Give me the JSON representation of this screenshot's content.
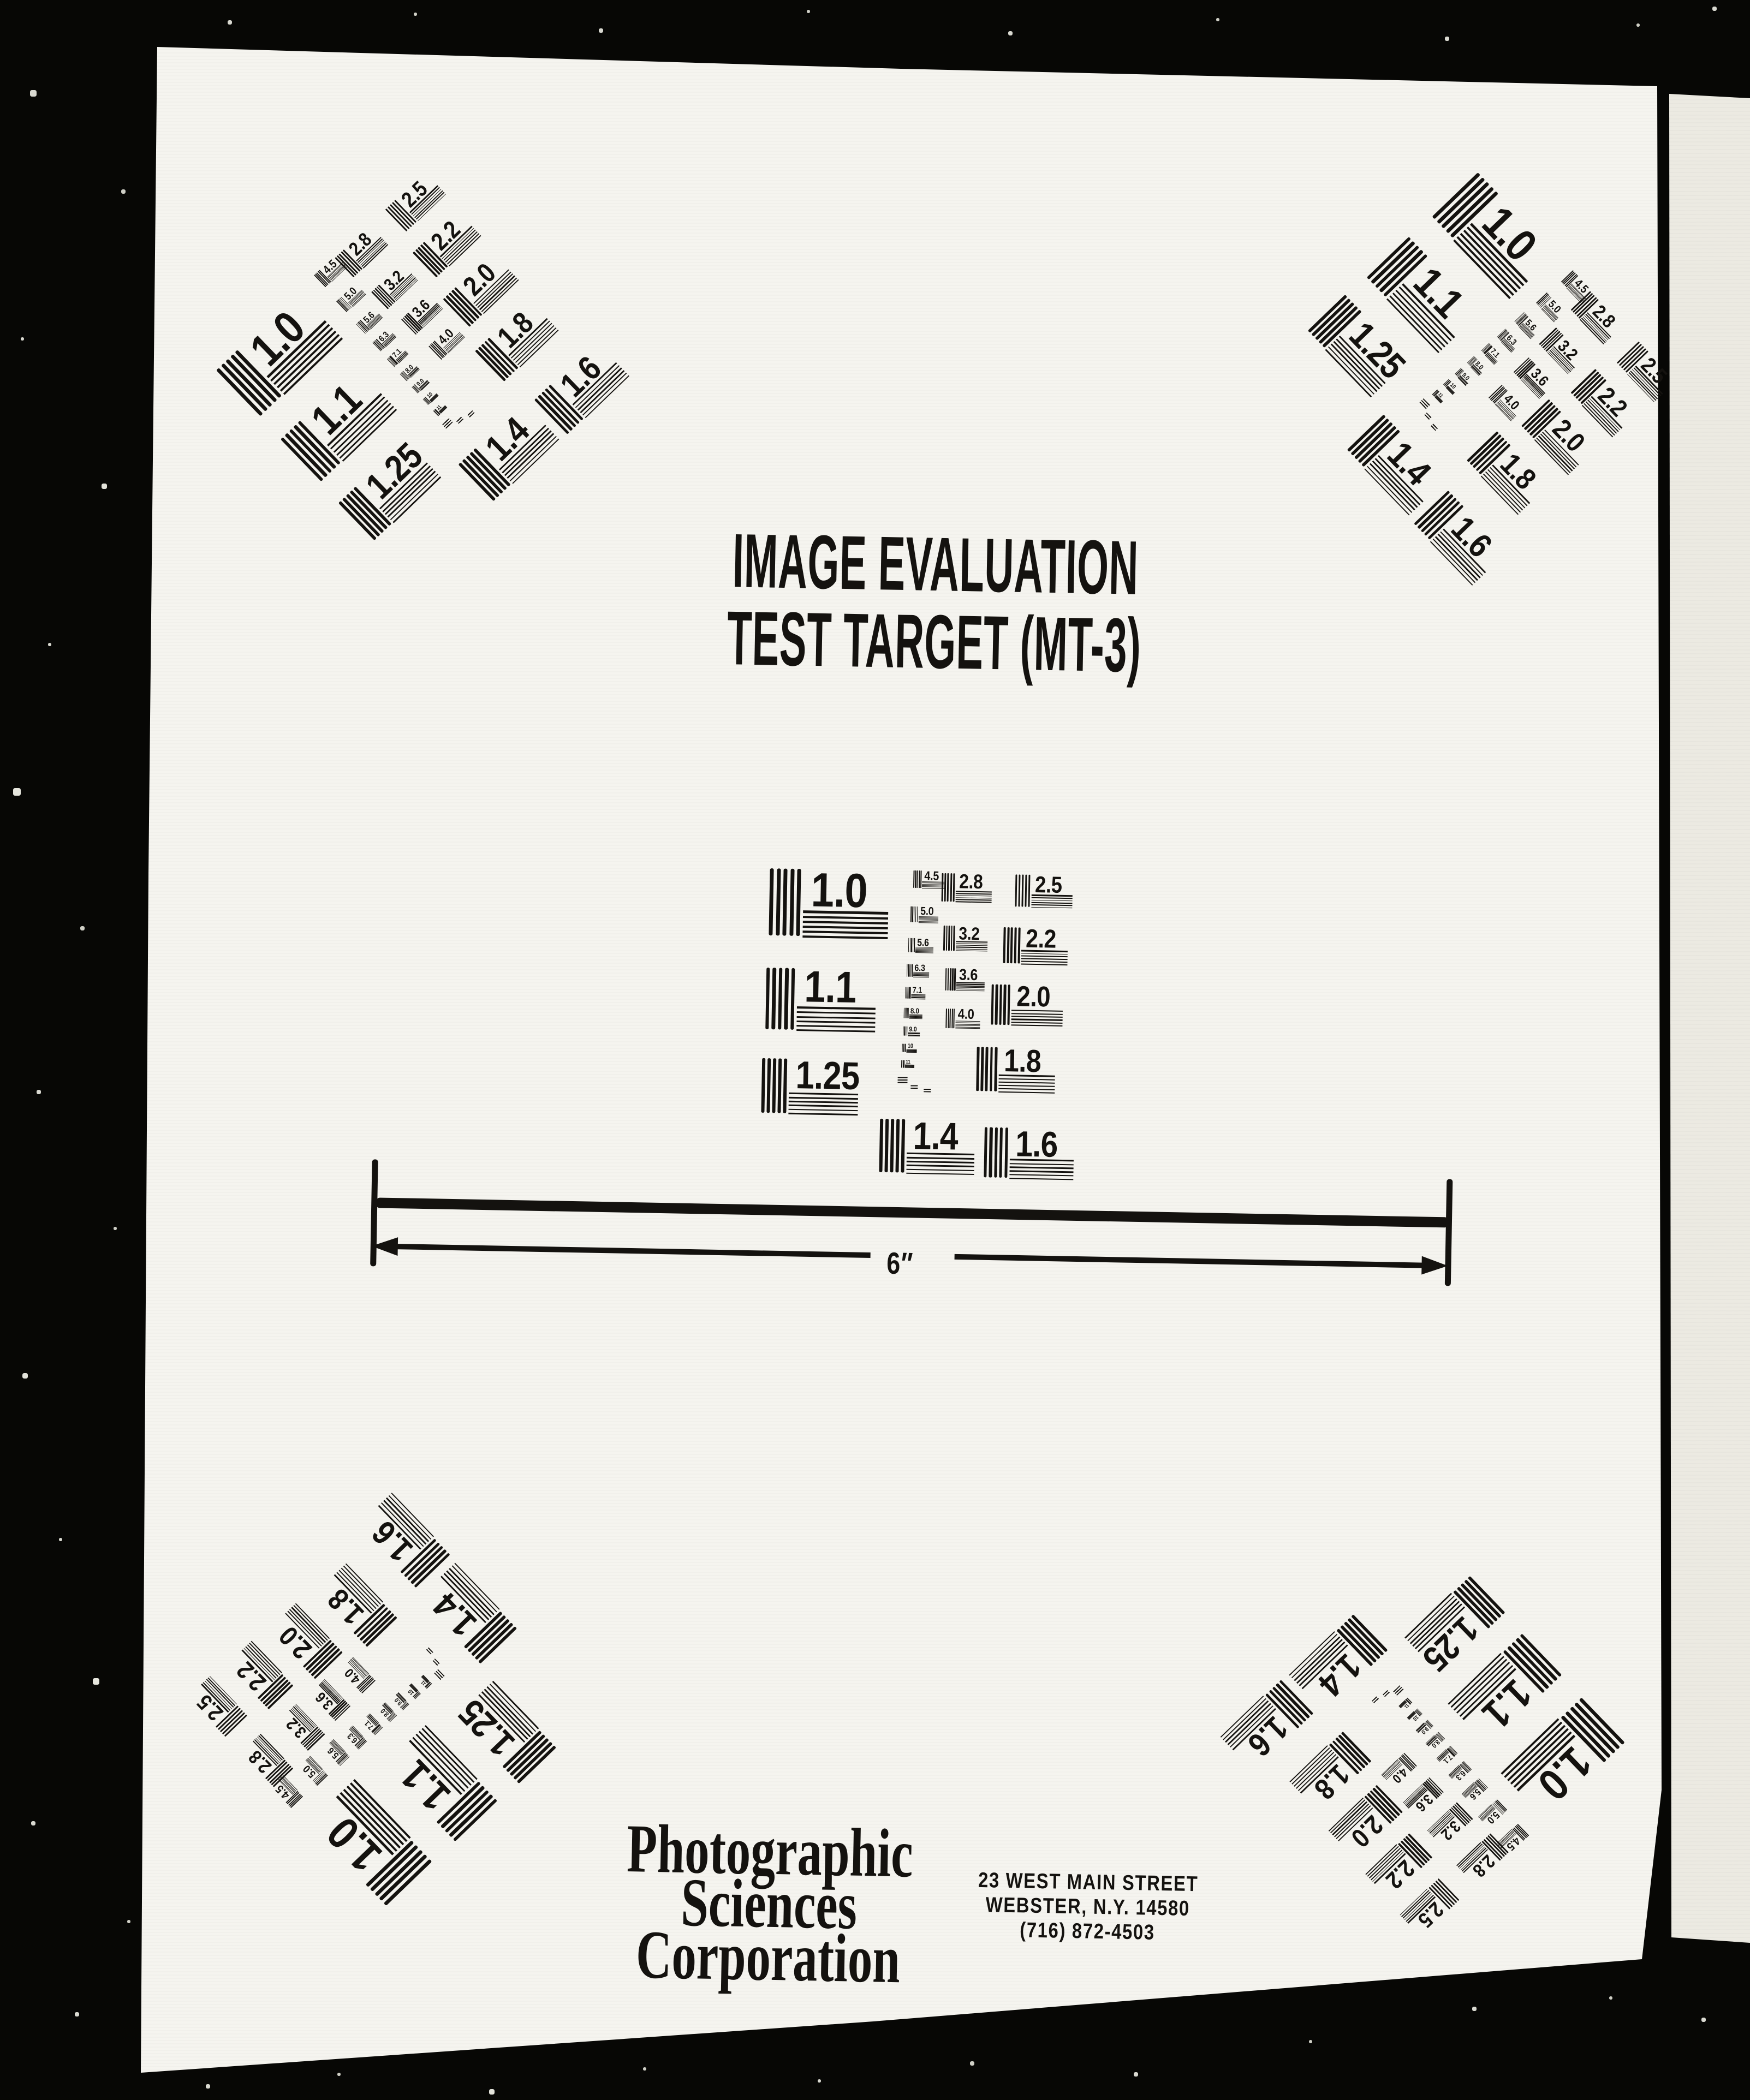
{
  "header": {
    "title_line1": "IMAGE EVALUATION",
    "title_line2": "TEST TARGET (MT-3)"
  },
  "scale_bar": {
    "label": "6″"
  },
  "test_pattern": {
    "large_values": [
      "1.0",
      "1.1",
      "1.25",
      "1.4",
      "1.6",
      "1.8",
      "2.0",
      "2.2",
      "2.5",
      "2.8",
      "3.2",
      "3.6",
      "4.0"
    ],
    "small_values": [
      "4.5",
      "5.0",
      "5.6",
      "6.3",
      "7.1",
      "8.0",
      "9.0",
      "10",
      "11"
    ],
    "instances": [
      {
        "position": "top-left",
        "rotation_deg": -45
      },
      {
        "position": "top-right",
        "rotation_deg": 45
      },
      {
        "position": "center",
        "rotation_deg": 0
      },
      {
        "position": "bottom-left",
        "rotation_deg": -135
      },
      {
        "position": "bottom-right",
        "rotation_deg": 135
      }
    ]
  },
  "footer": {
    "company_lines": [
      "Photographic",
      "Sciences",
      "Corporation"
    ],
    "address_lines": [
      "23 WEST MAIN STREET",
      "WEBSTER, N.Y. 14580",
      "(716) 872-4503"
    ]
  },
  "colors": {
    "film_background": "#070705",
    "page": "#f5f4ef",
    "side_strip": "#eceae2",
    "ink": "#14120f"
  }
}
